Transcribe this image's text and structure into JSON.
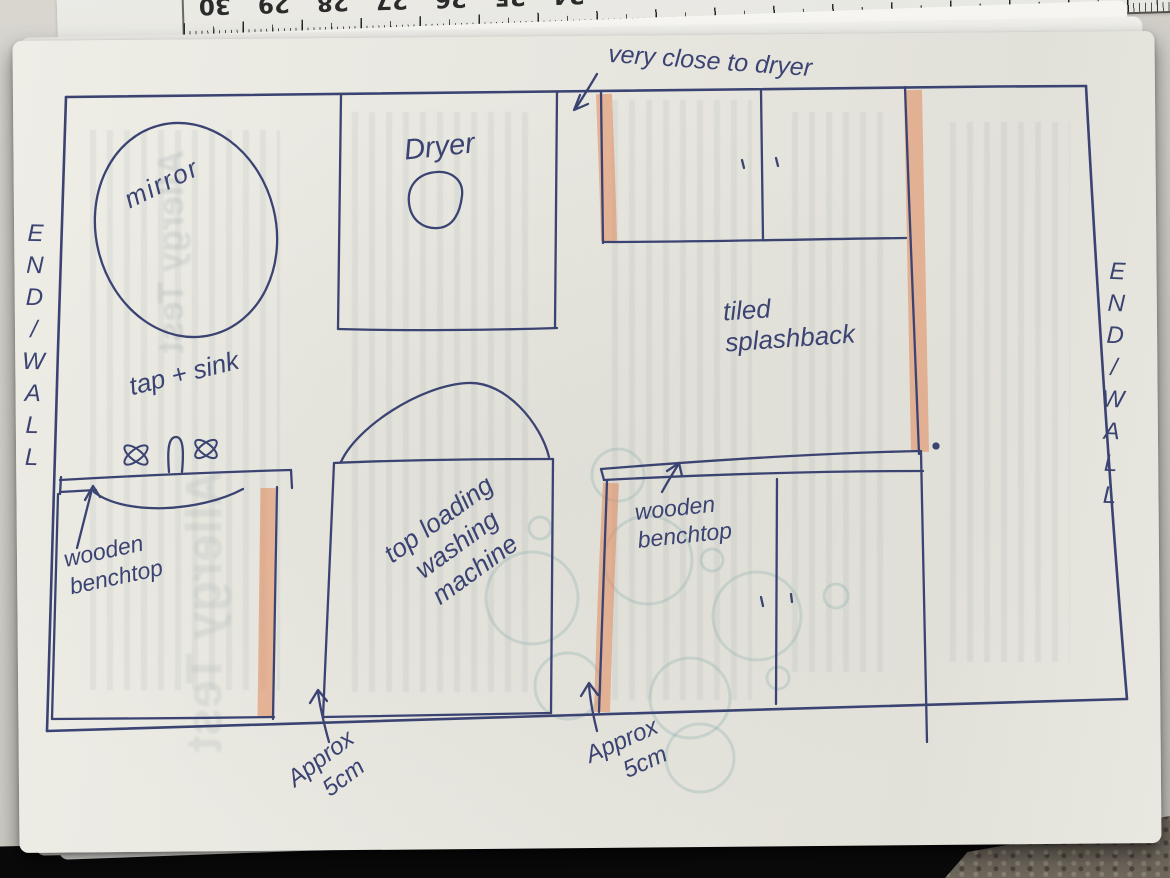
{
  "ruler": {
    "numbers": [
      "30",
      "29",
      "28",
      "27",
      "26",
      "25",
      "24"
    ]
  },
  "sketch": {
    "labels": {
      "very_close": "very close to dryer",
      "dryer": "Dryer",
      "mirror": "mirror",
      "tap_sink": "tap + sink",
      "wooden_benchtop_left": {
        "line1": "wooden",
        "line2": "benchtop"
      },
      "washing_machine": {
        "line1": "top loading",
        "line2": "washing",
        "line3": "machine"
      },
      "tiled_splashback": {
        "line1": "tiled",
        "line2": "splashback"
      },
      "wooden_benchtop_right": {
        "line1": "wooden",
        "line2": "benchtop"
      },
      "approx_left": {
        "line1": "Approx",
        "line2": "5cm"
      },
      "approx_right": {
        "line1": "Approx",
        "line2": "5cm"
      },
      "end_wall_left": "END/WALL",
      "end_wall_right": "END/WALL"
    },
    "ghost_text": "Allergy Test",
    "colors": {
      "ink": "#3b4372",
      "highlight": "#e0885c",
      "paper": "#e9e8e1"
    }
  }
}
